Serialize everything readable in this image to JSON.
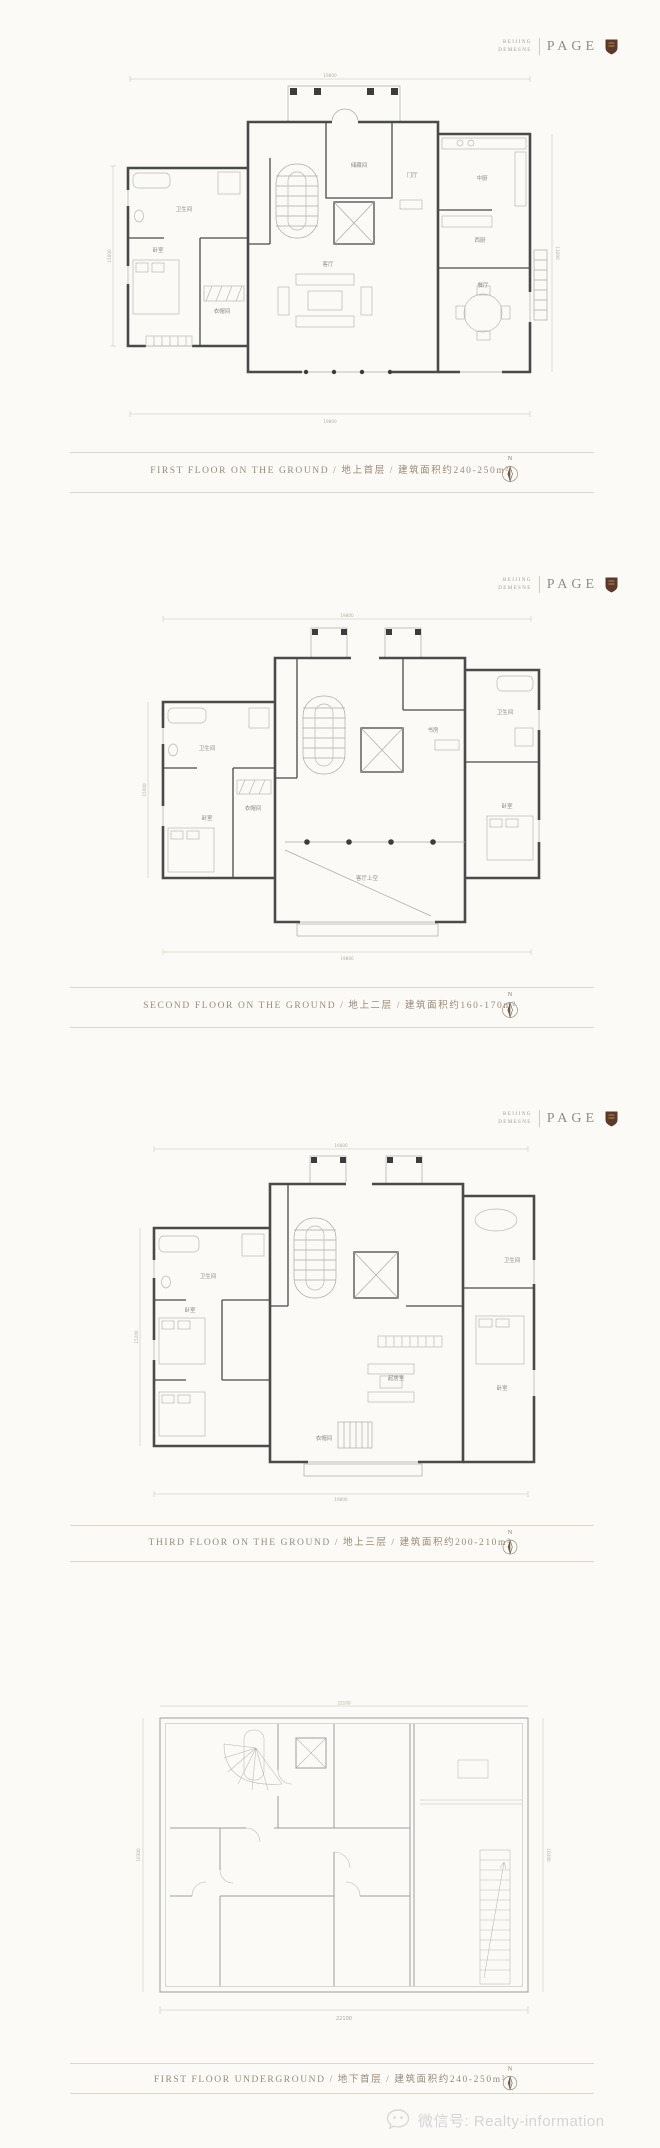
{
  "brand": {
    "top": "BEIJING",
    "bottom": "DEMESNE",
    "name": "PAGE"
  },
  "compass": {
    "label": "N"
  },
  "floors": [
    {
      "caption": "FIRST FLOOR ON THE GROUND / 地上首层 / 建筑面积约240-250m²",
      "rooms": {
        "foyer": "门厅",
        "storage": "储藏间",
        "bath": "卫生间",
        "cloak": "衣帽间",
        "bedroom": "卧室",
        "cn_kitchen": "中厨",
        "west_kitchen": "西厨",
        "dining": "餐厅",
        "living": "客厅"
      },
      "dims": {
        "top": "19800",
        "bottom": "19800",
        "left": "15000",
        "right": "13200"
      }
    },
    {
      "caption": "SECOND FLOOR ON THE GROUND / 地上二层 / 建筑面积约160-170m²",
      "rooms": {
        "bath_l": "卫生间",
        "cloak": "衣帽间",
        "bedroom_l": "卧室",
        "study": "书房",
        "bath_r": "卫生间",
        "bedroom_r": "卧室",
        "void": "客厅上空"
      },
      "dims": {
        "top": "19800",
        "bottom": "19800",
        "left": "15000"
      }
    },
    {
      "caption": "THIRD FLOOR ON THE GROUND / 地上三层 / 建筑面积约200-210m²",
      "rooms": {
        "bath_l": "卫生间",
        "bedroom_l": "卧室",
        "sitting": "起居室",
        "cloak": "衣帽间",
        "bath_r": "卫生间",
        "bedroom_r": "卧室"
      },
      "dims": {
        "top": "19800",
        "bottom": "19800",
        "left": "15200"
      }
    },
    {
      "caption": "FIRST FLOOR UNDERGROUND / 地下首层 / 建筑面积约240-250m²",
      "dims": {
        "top": "22100",
        "bottom": "22100",
        "left": "10300",
        "right": "10300"
      }
    }
  ],
  "watermark": {
    "text": "微信号: Realty-information"
  },
  "colors": {
    "caption": "#9a8a78",
    "shield": "#5c392b",
    "wall": "#4a4a4a",
    "watermark": "#d5d5d5"
  }
}
